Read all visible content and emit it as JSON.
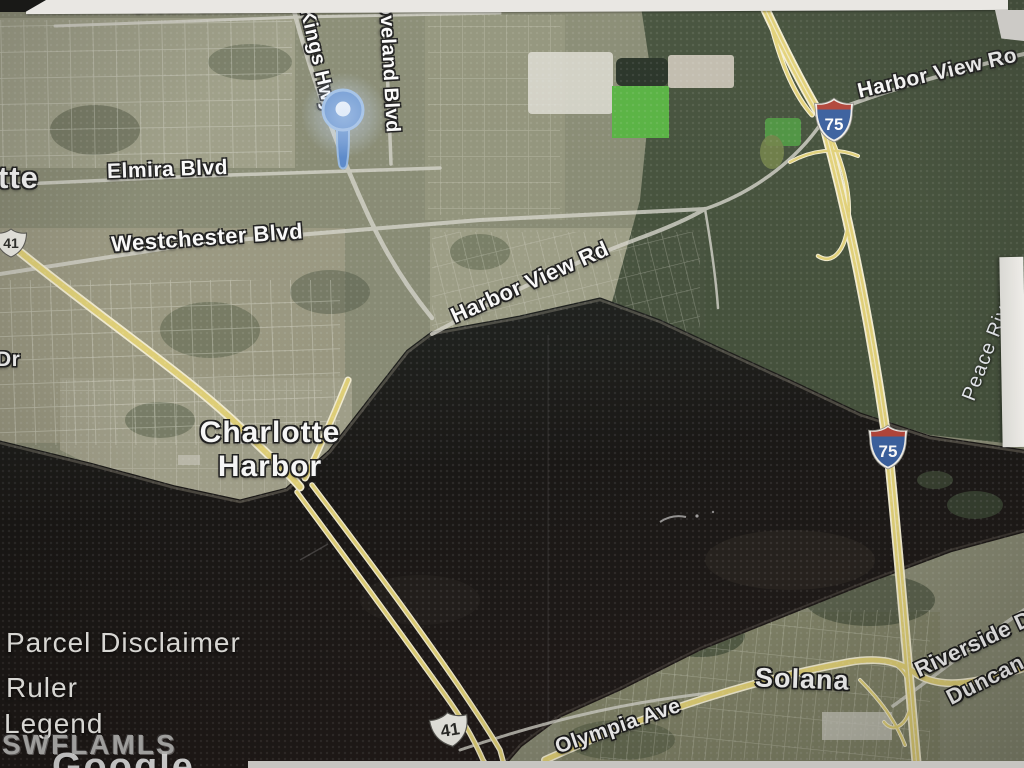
{
  "map": {
    "localities": {
      "port_charlotte_partial": "tte",
      "charlotte_harbor_line1": "Charlotte",
      "charlotte_harbor_line2": "Harbor",
      "solana": "Solana"
    },
    "streets": {
      "olean": "Olean Blvd",
      "elmira": "Elmira Blvd",
      "westchester": "Westchester Blvd",
      "kings_hwy": "Kings Hwy",
      "loveland_partial": "oveland Blvd",
      "harbor_view_mid": "Harbor View Rd",
      "harbor_view_ne": "Harbor View Ro",
      "olympia": "Olympia Ave",
      "riverside_partial": "Riverside D",
      "duncan_partial": "Duncan",
      "dr_partial": "Dr"
    },
    "water_labels": {
      "peace_river": "Peace River"
    },
    "route_shields": {
      "us_route_41": "41",
      "interstate_75": "75"
    },
    "overlay_controls": {
      "parcel_disclaimer": "Parcel Disclaimer",
      "ruler": "Ruler",
      "legend": "Legend"
    },
    "watermark": "SWFLAMLS",
    "attribution": "Google",
    "colors": {
      "pin_blue": "#4e87d6",
      "highway_yellow": "#e6d264",
      "interstate_blue": "#2d5ba8",
      "interstate_red": "#bf3a2d",
      "water_dark": "#14110e"
    }
  }
}
